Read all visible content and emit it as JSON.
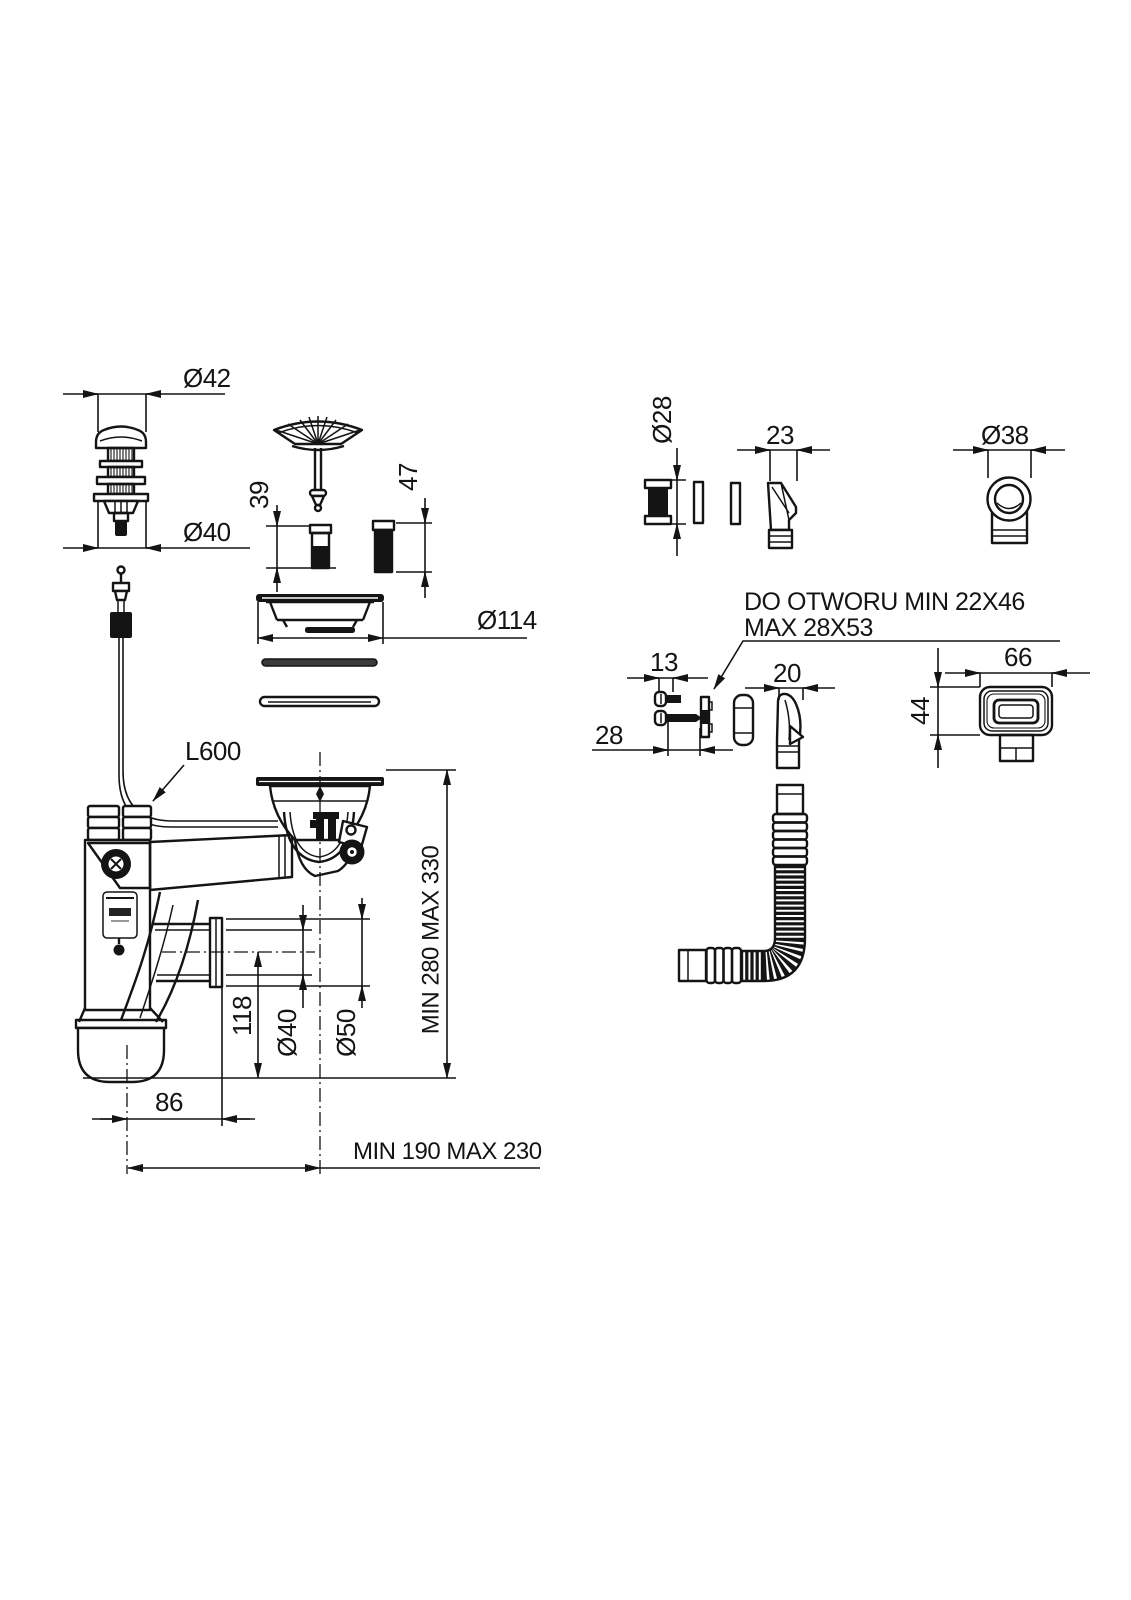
{
  "drawing": {
    "title_hint": "sink waste and siphon installation drawing",
    "background": "#ffffff",
    "ink": "#141414",
    "dims": {
      "d42": "Ø42",
      "d40_top": "Ø40",
      "d39": "39",
      "d47": "47",
      "d114": "Ø114",
      "cable_length": "L600",
      "height_range": "MIN 280 MAX 330",
      "d118": "118",
      "d40_out": "Ø40",
      "d50_out": "Ø50",
      "d86": "86",
      "reach_range": "MIN 190 MAX 230",
      "d28_plug": "Ø28",
      "d23": "23",
      "d38": "Ø38",
      "d13": "13",
      "d28_screw": "28",
      "d20": "20",
      "d66": "66",
      "d44": "44"
    },
    "notes": {
      "hole_line1": "DO OTWORU MIN 22X46",
      "hole_line2": "MAX 28X53"
    }
  }
}
